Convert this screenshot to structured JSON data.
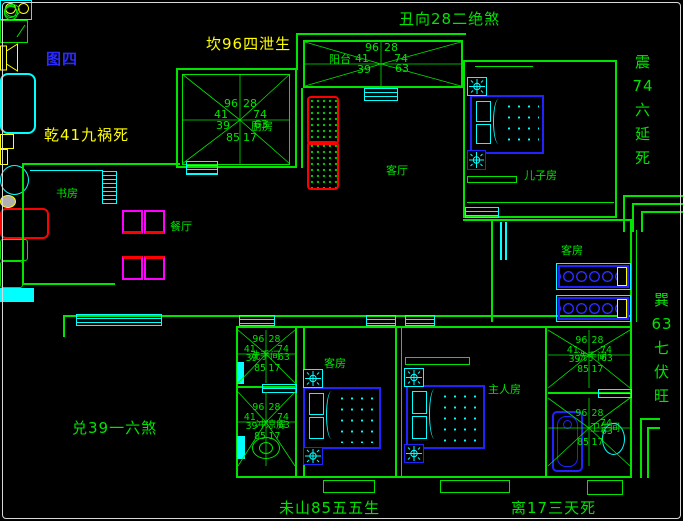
{
  "figure_label": "图四",
  "annotations": {
    "kan": "坎96四泄生",
    "chou": "丑向28二绝煞",
    "qian": "乾41九祸死",
    "dui": "兑39一六煞",
    "wei": "未山85五五生",
    "li": "离17三天死",
    "zhen": [
      "震",
      "74",
      "六",
      "延",
      "死"
    ],
    "xun": [
      "巽",
      "63",
      "七",
      "伏",
      "旺"
    ]
  },
  "rooms": {
    "kitchen": "厨房",
    "balcony": "阳台",
    "living": "客厅",
    "son_room": "儿子房",
    "study": "书房",
    "dining": "餐厅",
    "guest_room_right": "客房",
    "guest_room_lower": "客房",
    "master": "主人房",
    "washroom_left": "洗手间",
    "shower_room": "冲凉房",
    "washroom_right": "洗手间",
    "bathroom": "卫生间"
  },
  "compass_numbers": {
    "top_left": "96",
    "top_right": "28",
    "left": "41",
    "right": "74",
    "lower_left": "39",
    "lower_right": "63",
    "bottom_left": "85",
    "bottom_right": "17"
  },
  "colors": {
    "wall_green": "#00e400",
    "cyan": "#00ffff",
    "blue": "#2222ff",
    "yellow": "#ffff00",
    "red": "#ff0000",
    "magenta": "#ff00ff",
    "title_blue": "#2b2bff"
  }
}
